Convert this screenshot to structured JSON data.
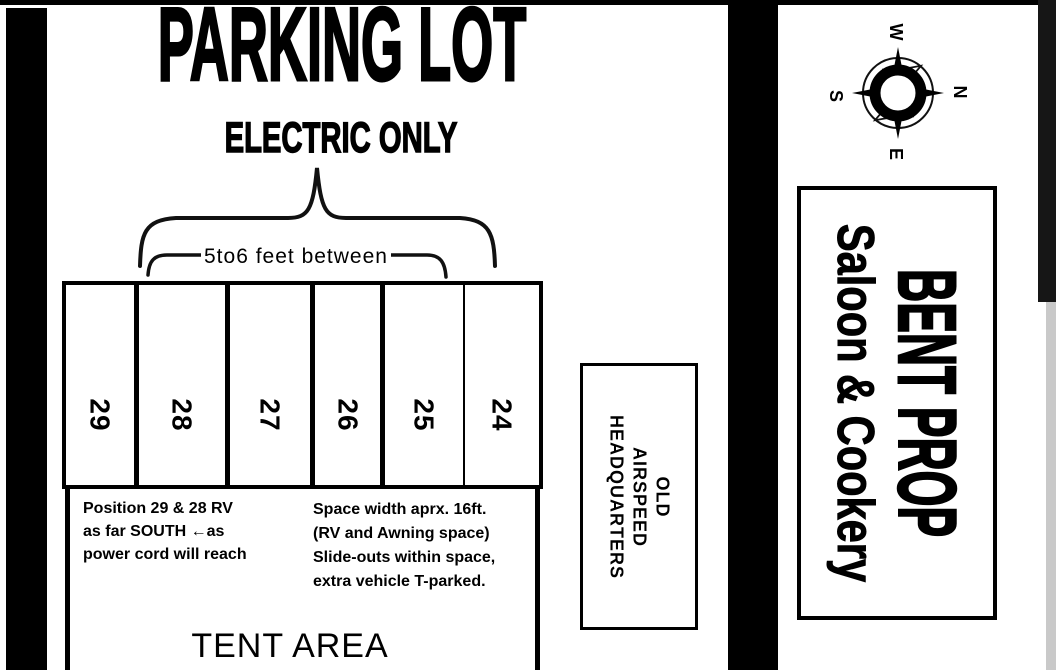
{
  "header": {
    "title": "PARKING LOT",
    "subtitle": "ELECTRIC ONLY"
  },
  "measurements": {
    "between_note": "5to6 feet between"
  },
  "parking": {
    "spaces": [
      "29",
      "28",
      "27",
      "26",
      "25",
      "24"
    ]
  },
  "notes": {
    "left_lines": [
      "Position 29 & 28 RV",
      "as far SOUTH ←as",
      "power cord will reach"
    ],
    "right_lines": [
      "Space width aprx. 16ft.",
      "(RV and Awning space)",
      "Slide-outs within space,",
      "extra vehicle T-parked."
    ]
  },
  "tent": {
    "label": "TENT AREA"
  },
  "buildings": {
    "old_hq_line1": "OLD",
    "old_hq_line2": "AIRSPEED",
    "old_hq_line3": "HEADQUARTERS",
    "saloon_title": "BENT PROP",
    "saloon_subtitle": "Saloon & Cookery"
  },
  "compass": {
    "top": "W",
    "right": "N",
    "bottom": "E",
    "left": "S"
  },
  "colors": {
    "ink": "#000000",
    "paper": "#ffffff"
  }
}
